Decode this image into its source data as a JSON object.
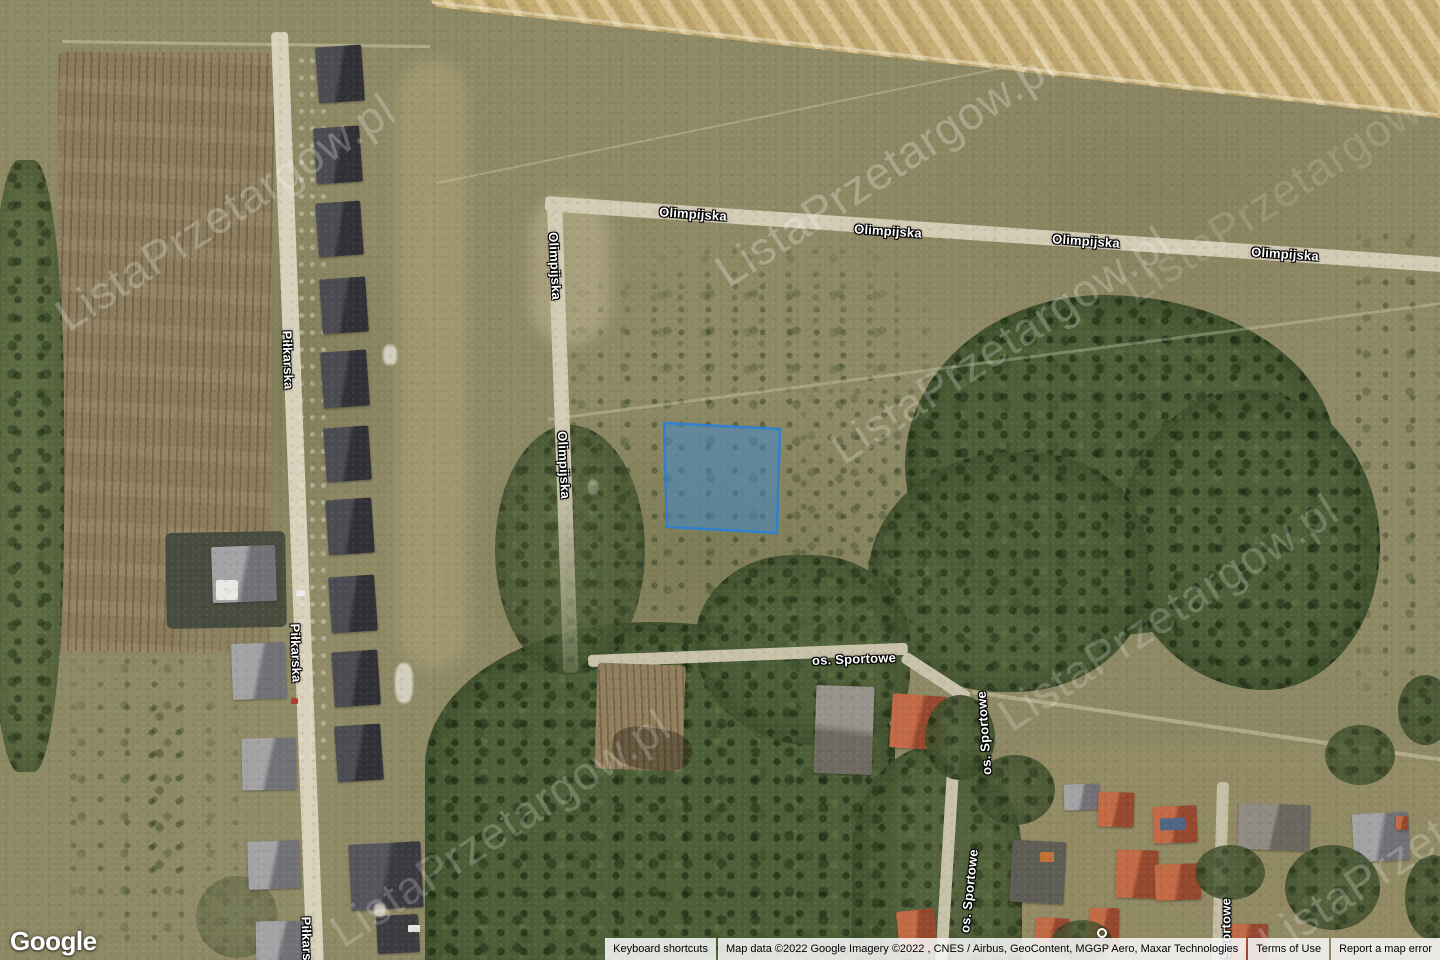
{
  "map_labels": {
    "olimpijska": "Olimpijska",
    "pilkarska": "Piłkarska",
    "sportowe": "os. Sportowe"
  },
  "watermark": {
    "text": "ListaPrzetargow.pl"
  },
  "branding": {
    "logo_text": "Google"
  },
  "attribution_bar": {
    "keyboard_shortcuts": "Keyboard shortcuts",
    "map_data": "Map data ©2022 Google Imagery ©2022 , CNES / Airbus, GeoContent, MGGP Aero, Maxar Technologies",
    "terms_of_use": "Terms of Use",
    "report_error": "Report a map error"
  },
  "parcel": {
    "fill": "#3d8ad3",
    "stroke": "#2a7fd6",
    "fill_opacity": "0.5",
    "stroke_opacity": "0.9"
  }
}
